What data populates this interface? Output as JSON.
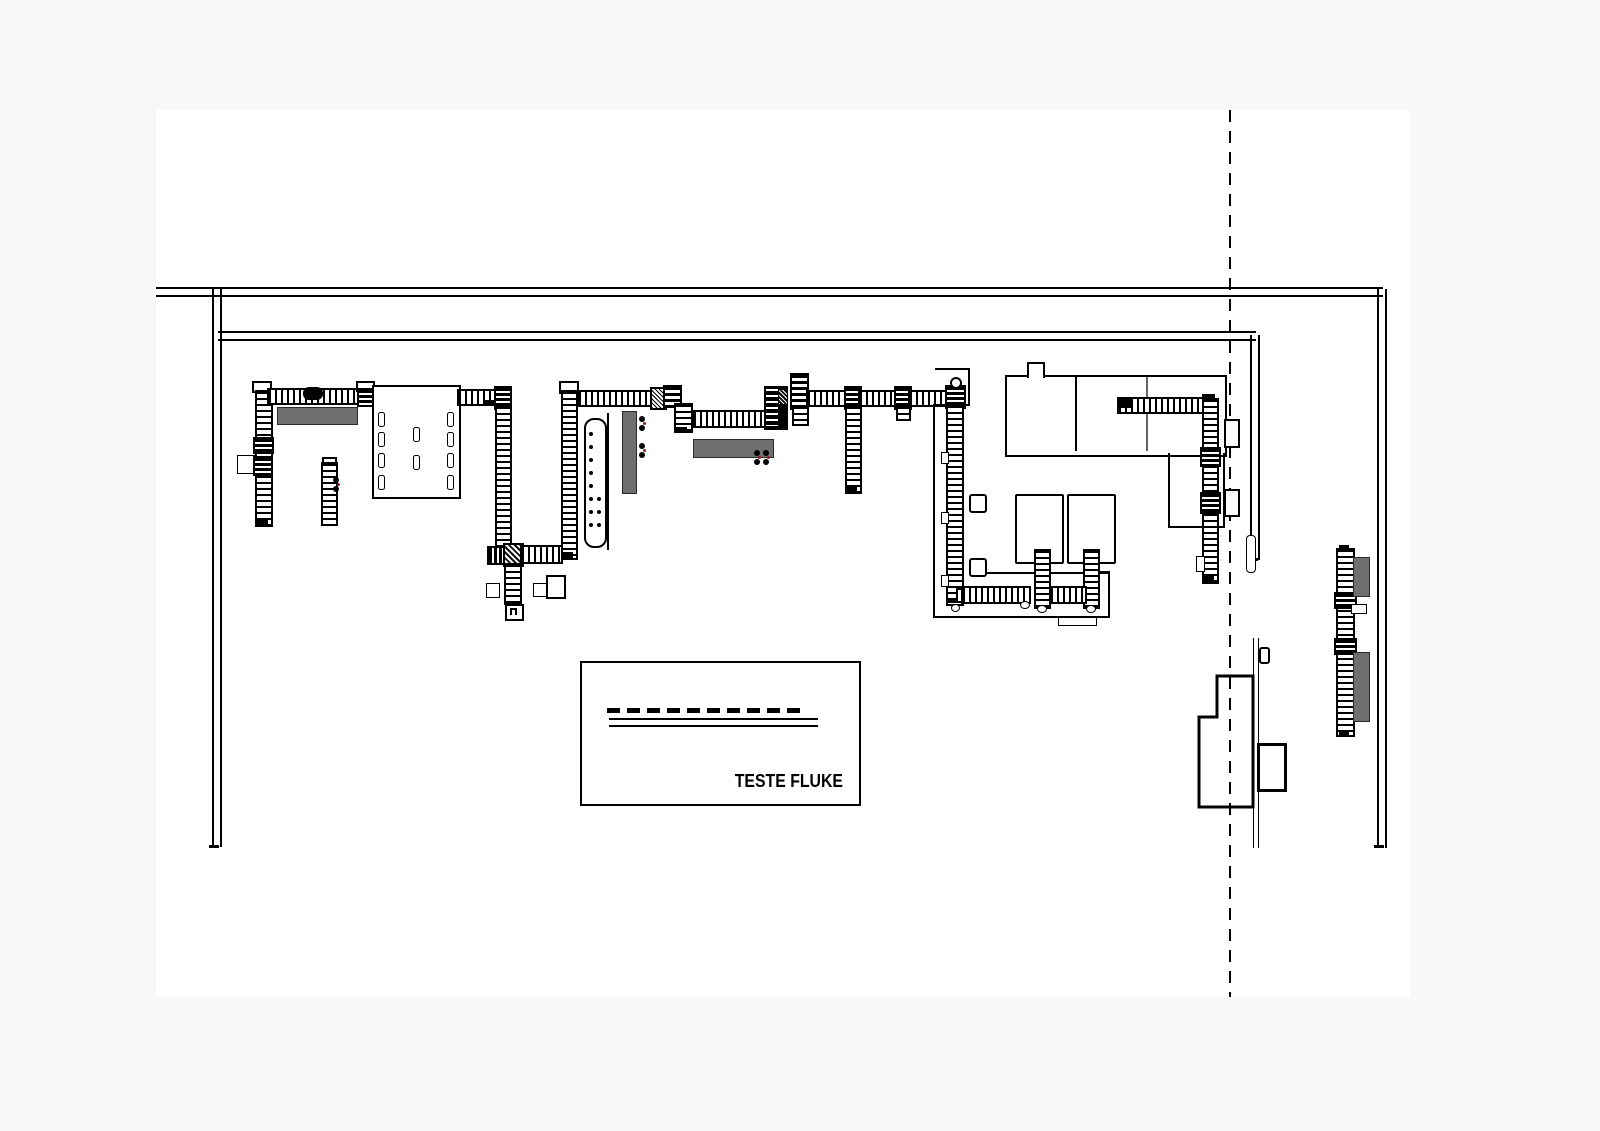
{
  "document": {
    "type": "factory floor plan CAD drawing",
    "test_area_label": "TESTE FLUKE"
  },
  "colors": {
    "canvas_background": "#f8f8f8",
    "paper": "#ffffff",
    "line": "#000000",
    "equipment_gray": "#6f6f6f",
    "marker_red": "#8a1f1f"
  }
}
